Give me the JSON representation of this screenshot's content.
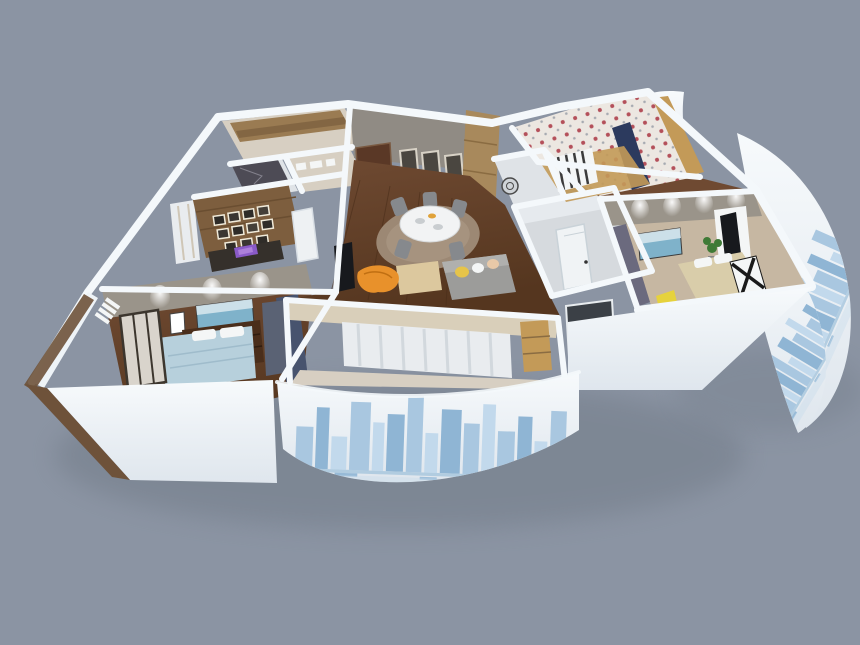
{
  "scene": {
    "type": "3d-floorplan-cutaway-render",
    "background": "#8b94a3"
  },
  "palette": {
    "bg": "#8b94a3",
    "shadow": "#6e7884",
    "wall_face": "#f7fafc",
    "wall_face_dark": "#dfe6ed",
    "wall_stroke": "#f4f8fb",
    "floor_wood": "#6f4a32",
    "floor_wood_dark": "#55361f",
    "floor_pale": "#d7cfc2",
    "floor_tan": "#c6b7a2",
    "wall_gray": "#908b84",
    "wall_taupe": "#9a948a",
    "wood_shelf": "#9a7b52",
    "wood_panel": "#7d5e3e",
    "wood_cabinet": "#a8895c",
    "wood_light": "#c39a58",
    "marble_dark": "#4d4b55",
    "door_brown": "#5a3826",
    "navy": "#2c3a5e",
    "navy_soft": "#47536e",
    "slate": "#5a6274",
    "window_dark": "#3b4046",
    "rug": "#9c8874",
    "rug_light": "#ab9884",
    "table_white": "#f2f3f4",
    "chair_gray": "#86898d",
    "sofa_gray": "#9c9c9a",
    "pillow_yellow": "#e6c44a",
    "ottoman": "#dcc89e",
    "blanket_orange": "#e8912b",
    "tv_black": "#17191d",
    "painting_sea": "#7fb2ca",
    "bed_blue": "#b7d0dc",
    "bed_beige": "#d9cdaa",
    "bench_purple": "#6b6a7e",
    "dresser": "#4a2e1b",
    "curtain": "#e9ecef",
    "balcony_beige": "#d9cfba",
    "bath_wall": "#d6dade",
    "bath_floor": "#dfe3e7",
    "wallpaper": "#ece7e1",
    "floral_red": "#b4505a",
    "plant_green": "#3f7a36",
    "yellow_cloth": "#e6d23c",
    "wood_trim": "#6e523a",
    "sky1": "#a9c7e0",
    "sky2": "#c2d9ec",
    "sky3": "#8fb5d4",
    "water": "#9cc0da",
    "white": "#f4f6f6"
  }
}
